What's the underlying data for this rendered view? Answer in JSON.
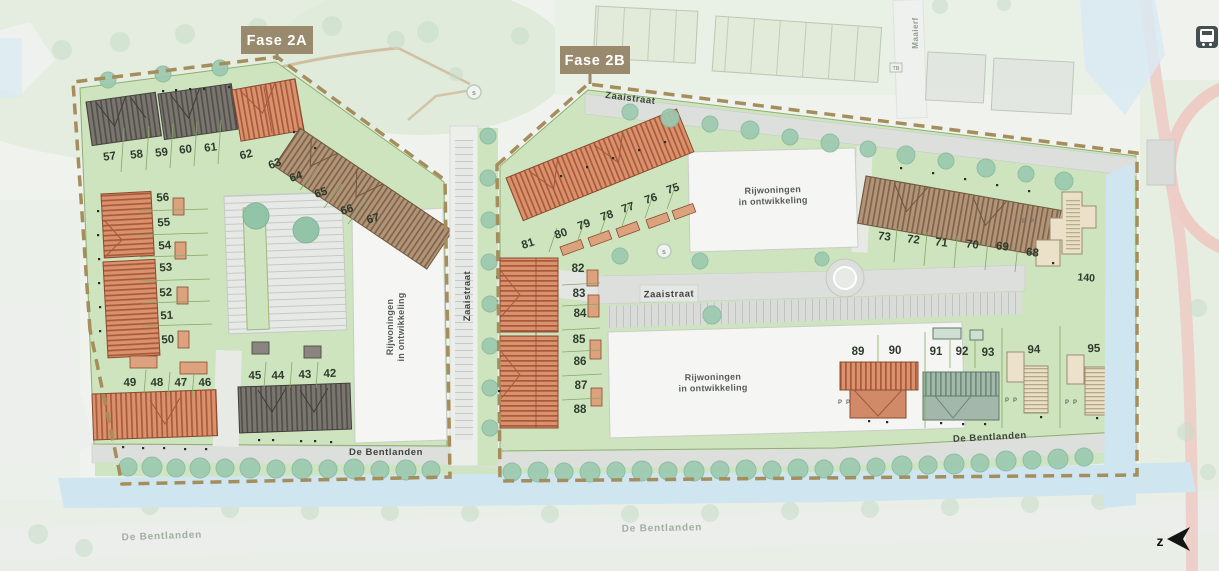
{
  "phase_labels": {
    "fase_2a": "Fase 2A",
    "fase_2b": "Fase 2B"
  },
  "streets": {
    "zaaistraat": "Zaaistraat",
    "de_bentlanden": "De Bentlanden",
    "maaierf": "Maaierf"
  },
  "development_note": {
    "line1": "Rijwoningen",
    "line2": "in ontwikkeling"
  },
  "compass": {
    "south": "z"
  },
  "markers": {
    "parking": "P",
    "playground": "s",
    "utility_box": "TB"
  },
  "plots2a": {
    "row_5761": [
      "57",
      "58",
      "59",
      "60",
      "61"
    ],
    "pair_6263": [
      "62",
      "63"
    ],
    "row_6467": [
      "64",
      "65",
      "66",
      "67"
    ],
    "col_5056": [
      "56",
      "55",
      "54",
      "53",
      "52",
      "51",
      "50"
    ],
    "row_4649": [
      "49",
      "48",
      "47",
      "46"
    ],
    "row_4245": [
      "45",
      "44",
      "43",
      "42"
    ]
  },
  "plots2b": {
    "row_7581": [
      "81",
      "80",
      "79",
      "78",
      "77",
      "76",
      "75"
    ],
    "col_8288": [
      "82",
      "83",
      "84",
      "85",
      "86",
      "87",
      "88"
    ],
    "row_6873": [
      "73",
      "72",
      "71",
      "70",
      "69",
      "68"
    ],
    "plot_140": "140",
    "row_8995": [
      "89",
      "90",
      "91",
      "92",
      "93",
      "94",
      "95"
    ]
  },
  "colors": {
    "boundary": "#a58d5c",
    "label_box": "#9a8a6d",
    "plot_green": "#cde4bf",
    "roof_red": "#d9916e",
    "roof_brown": "#b29478",
    "roof_dark": "#7a756f",
    "roof_slate_green": "#a2b8aa",
    "building_beige": "#e9dfc5",
    "water": "#cfe5f0",
    "road": "#dcdfdb",
    "tree": "#9ccab0"
  }
}
